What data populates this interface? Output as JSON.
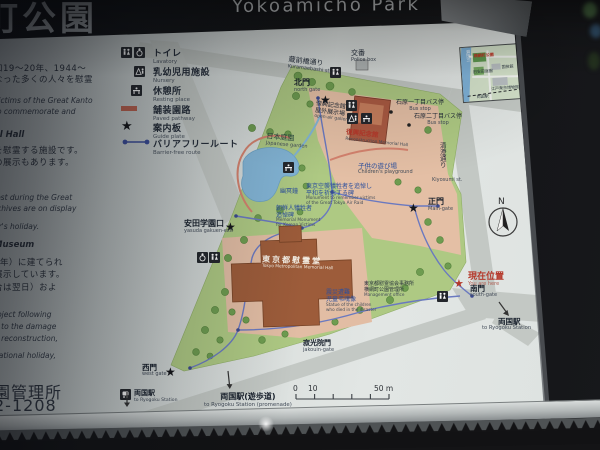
{
  "header": {
    "title_jp": "町公園",
    "title_en": "Yokoamicho Park"
  },
  "legend": {
    "items": [
      {
        "jp": "トイレ",
        "en": "Lavatory"
      },
      {
        "jp": "乳幼児用施設",
        "en": "Nursery"
      },
      {
        "jp": "休憩所",
        "en": "Resting place"
      },
      {
        "jp": "舗装園路",
        "en": "Paved pathway"
      },
      {
        "jp": "案内板",
        "en": "Guide plate"
      },
      {
        "jp": "バリアフリールート",
        "en": "Barrier-free route"
      }
    ]
  },
  "left_text": {
    "lines": [
      {
        "t": "和19～20年、1944～"
      },
      {
        "t": "なった多くの人々を慰霊"
      },
      {
        "t": "victims of the Great Kanto"
      },
      {
        "t": "to commemorate and"
      },
      {
        "t": "al Hall"
      },
      {
        "t": "を慰霊する施設です。"
      },
      {
        "t": "の展示もあります。"
      },
      {
        "t": "lost during the Great"
      },
      {
        "t": "rchives are on display"
      },
      {
        "t": "ar's holiday."
      },
      {
        "t": "Museum"
      },
      {
        "t": "1年）に建てられ"
      },
      {
        "t": "展示しています。"
      },
      {
        "t": "合は翌日）およ"
      },
      {
        "t": "roject following"
      },
      {
        "t": "d to the damage"
      },
      {
        "t": "g reconstruction,"
      },
      {
        "t": "national holiday,"
      },
      {
        "t": "園管理所"
      },
      {
        "t": "2-1208"
      }
    ]
  },
  "map": {
    "streets": {
      "kuramaebashi": {
        "jp": "蔵前橋通り",
        "en": "Kuramaebashi st."
      },
      "kiyosumi": {
        "jp": "清澄通り",
        "en": "Kiyosumi st."
      }
    },
    "gates": {
      "north": {
        "jp": "北門",
        "en": "north gate"
      },
      "main": {
        "jp": "正門",
        "en": "Main-gate"
      },
      "south": {
        "jp": "南門",
        "en": "south-gate"
      },
      "west": {
        "jp": "西門",
        "en": "west gate"
      },
      "jakouin": {
        "jp": "寂光院門",
        "en": "jakouin-gate"
      },
      "yasuda": {
        "jp": "安田学園口",
        "en": "yasuda gakuen-exit"
      }
    },
    "places": {
      "police": {
        "jp": "交番",
        "en": "Police box"
      },
      "garden": {
        "jp": "日本庭園",
        "en": "Japanese garden"
      },
      "bell": {
        "jp": "幽冥鐘"
      },
      "playground": {
        "jp": "子供の遊び場",
        "en": "Children's playground"
      },
      "memorial_hall": {
        "jp": "東京都慰霊堂",
        "en": "Tokyo Metropolitan Memorial Hall"
      },
      "reconstruction_hall": {
        "jp": "復興記念館",
        "en": "Reconstruction Memorial Hall"
      },
      "open_air_gallery": {
        "jp1": "復興記念館",
        "jp2": "屋外展示場",
        "en": "open-air gallery"
      },
      "office": {
        "jp1": "東京都慰霊協会事務所",
        "jp2": "横網町公園管理所",
        "en": "Management office"
      }
    },
    "monuments": {
      "air_raid": {
        "jp1": "東京空襲犠牲者を追悼し",
        "jp2": "平和を祈念する碑",
        "en1": "Monument to remember victims",
        "en2": "of the Great Tokyo Air Raid"
      },
      "korean": {
        "jp1": "朝鮮人犠牲者",
        "jp2": "追悼碑",
        "en1": "Memorial Monument",
        "en2": "for Korean Victims"
      },
      "children": {
        "jp1": "震災遭難",
        "jp2": "児童弔魂像",
        "en1": "Statue of the children",
        "en2": "who died in the disaster"
      }
    },
    "bus_stops": [
      {
        "jp": "石原一丁目バス停",
        "en": "Bus stop"
      },
      {
        "jp": "石原二丁目バス停",
        "en": "Bus stop"
      }
    ],
    "stations": {
      "ryogoku_east": {
        "jp": "両国駅",
        "en": "to Ryogoku Station"
      },
      "ryogoku_west": {
        "jp": "両国駅",
        "en": "to Ryogoku Station"
      },
      "ryogoku_promenade": {
        "jp": "両国駅(遊歩道)",
        "en": "to Ryogoku Station (promenade)"
      }
    },
    "you_are_here": {
      "jp": "現在位置",
      "en": "You are here"
    },
    "compass_n": "N",
    "scalebar": {
      "t0": "0",
      "t10": "10",
      "t50": "50 m"
    }
  },
  "inset": {
    "park": "横網町公園",
    "yasuda_garden": "旧安田庭園",
    "kokugikan": "国技館",
    "museum": "江戸東京博物館",
    "station": "両国駅",
    "river": "隅田川"
  },
  "icons": {
    "star": "★",
    "star_red": "★"
  },
  "colors": {
    "park_green": "#aec983",
    "paved_pink": "#e4bfa5",
    "building_brown": "#9d5c3a",
    "route_blue": "#6a79c0",
    "paved_path_red": "#d4826e",
    "accent_red": "#b5382a",
    "panel": "#d9dedc"
  }
}
